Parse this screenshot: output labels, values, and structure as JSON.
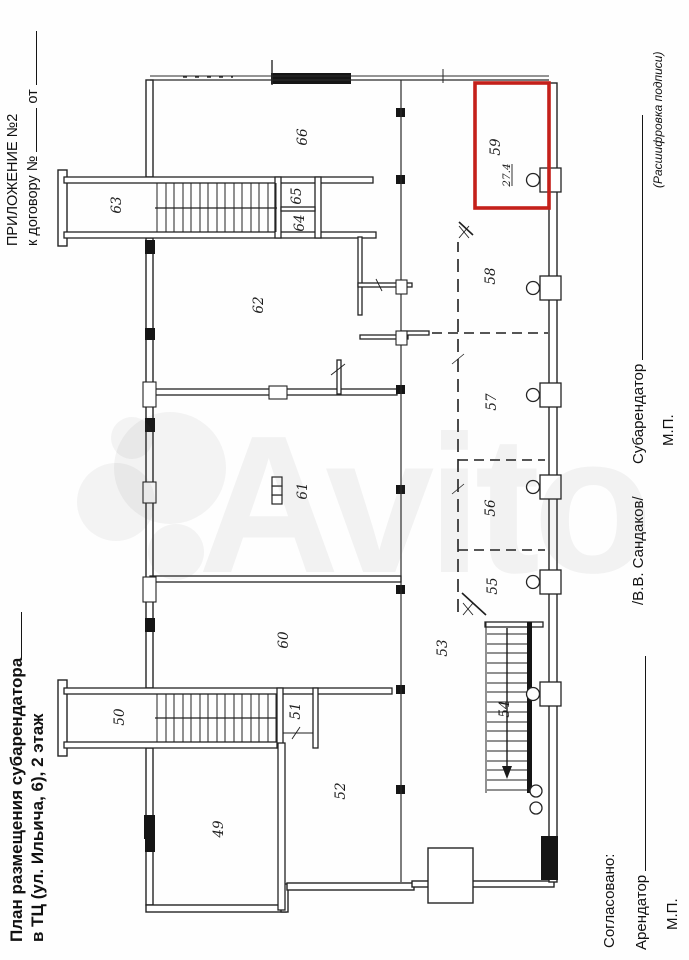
{
  "appendix": {
    "line1": "ПРИЛОЖЕНИЕ №2",
    "contract_prefix": "к договору №",
    "date_prefix": "от"
  },
  "title": {
    "line1": "План размещения субарендатора",
    "line2": "в ТЦ (ул. Ильича, 6), 2 этаж"
  },
  "plan": {
    "rooms": [
      {
        "number": "49"
      },
      {
        "number": "50"
      },
      {
        "number": "51"
      },
      {
        "number": "52"
      },
      {
        "number": "53"
      },
      {
        "number": "54"
      },
      {
        "number": "55"
      },
      {
        "number": "56"
      },
      {
        "number": "57"
      },
      {
        "number": "58"
      },
      {
        "number": "60"
      },
      {
        "number": "61"
      },
      {
        "number": "62"
      },
      {
        "number": "63"
      },
      {
        "number": "64"
      },
      {
        "number": "65"
      },
      {
        "number": "66"
      }
    ],
    "highlighted_room": {
      "number": "59",
      "area": "27.4",
      "color": "#c4201a"
    }
  },
  "signatures": {
    "agreed_label": "Согласовано:",
    "landlord_label": "Арендатор",
    "landlord_stamp": "М.П.",
    "subtenant_name": "/В.В. Сандаков/",
    "subtenant_label": "Субарендатор",
    "subtenant_stamp": "М.П.",
    "decryption_caption": "(Расшифровка подписи)"
  },
  "watermark": {
    "text": "Avito"
  }
}
